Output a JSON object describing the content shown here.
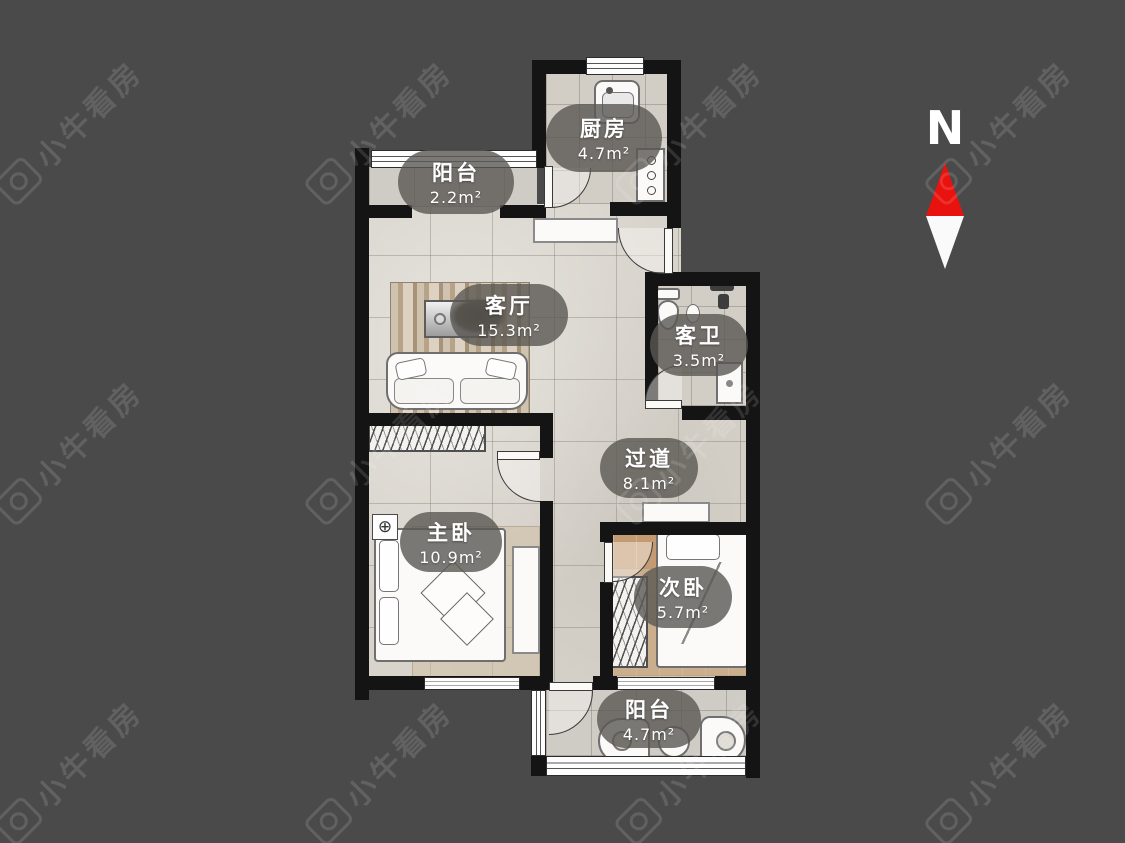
{
  "watermark": {
    "text": "小牛看房"
  },
  "compass": {
    "label": "N"
  },
  "rooms": [
    {
      "name": "厨房",
      "area": "4.7m²"
    },
    {
      "name": "阳台",
      "area": "2.2m²"
    },
    {
      "name": "客厅",
      "area": "15.3m²"
    },
    {
      "name": "客卫",
      "area": "3.5m²"
    },
    {
      "name": "过道",
      "area": "8.1m²"
    },
    {
      "name": "主卧",
      "area": "10.9m²"
    },
    {
      "name": "次卧",
      "area": "5.7m²"
    },
    {
      "name": "阳台",
      "area": "4.7m²"
    }
  ],
  "icons": {
    "crosshair_glyph": "⊕"
  },
  "colors": {
    "background": "#4a4a4a",
    "wall": "#141414",
    "tile_floor": "#d8d4cc",
    "wood_floor": "#c7a27b",
    "label_bubble": "rgba(90,87,82,0.8)",
    "north_arrow_red": "#e8120e",
    "north_arrow_white": "#fafafa"
  }
}
